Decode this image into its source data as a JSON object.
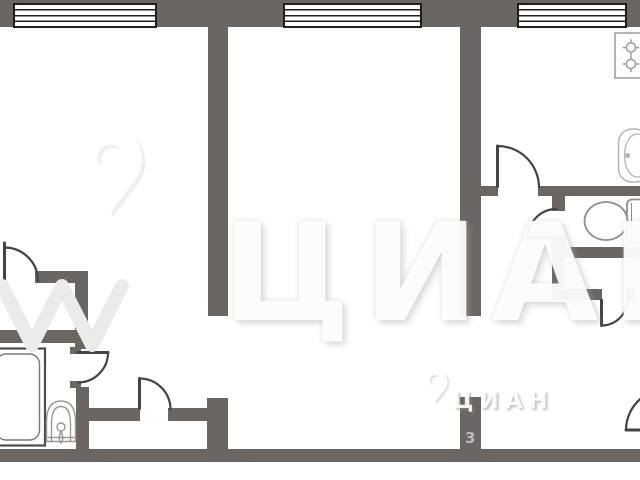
{
  "document": {
    "type": "apartment-floor-plan"
  },
  "watermark_large": {
    "brand": "ЦИАН",
    "logo_icon": "cian-pin-icon"
  },
  "watermark_small": {
    "brand": "ЦИАН",
    "number": "3",
    "logo_icon": "cian-pin-icon"
  },
  "fixtures": {
    "bathtub": "bathtub",
    "washbasin": "washbasin",
    "toilet": "toilet",
    "kitchen_sink": "kitchen-sink",
    "stove": "stove-2-burner"
  },
  "counts": {
    "windows": 3,
    "door_arcs": 7
  },
  "colors": {
    "wall": "#6C6662",
    "window_frame": "#1f1f1f",
    "door_stroke": "#464442",
    "fixture_stroke": "#908D8A",
    "background": "#ffffff"
  }
}
